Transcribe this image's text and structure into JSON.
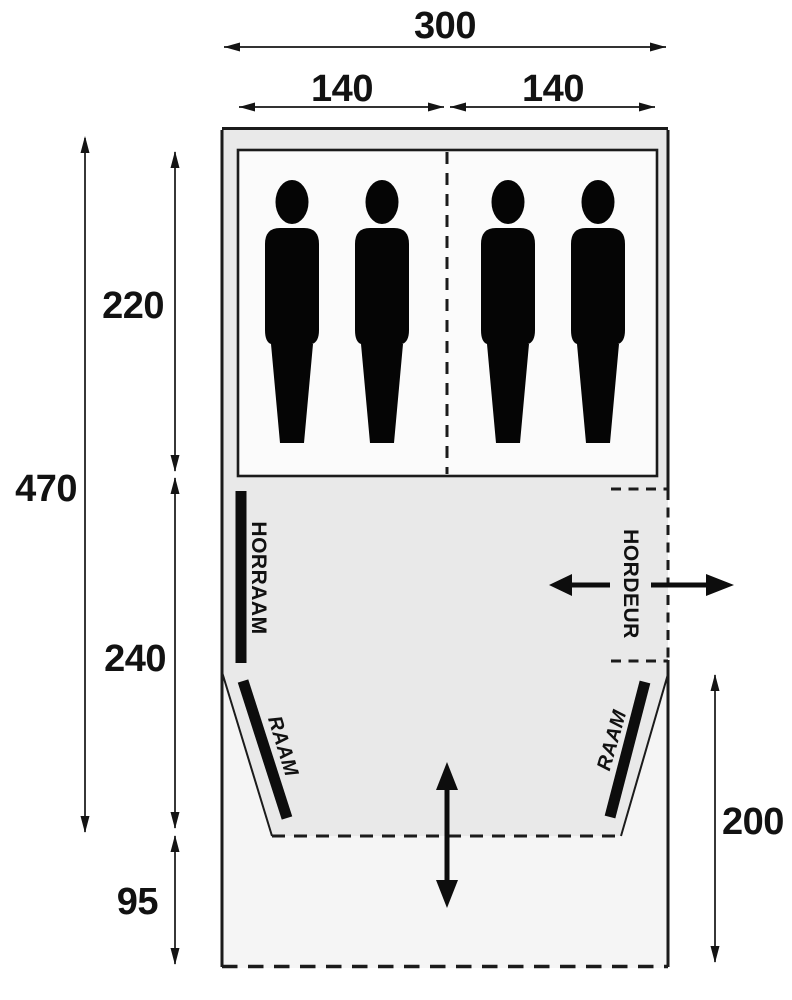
{
  "diagram": {
    "kind": "tent-floorplan",
    "dims": {
      "total_width": "300",
      "left_cabin_width": "140",
      "right_cabin_width": "140",
      "total_depth": "470",
      "sleeping_depth": "220",
      "living_depth": "240",
      "canopy_depth": "95",
      "side_section_depth": "200"
    },
    "labels": {
      "left_mesh_window": "HORRAAM",
      "side_mesh_door": "HORDEUR",
      "left_window": "RAAM",
      "right_window": "RAAM"
    },
    "figures": {
      "count": 4,
      "icon": "person-silhouette"
    },
    "colors": {
      "ink": "#141414",
      "living_area": "#e9e9e9",
      "sleeping_area": "#fbfbfb",
      "canopy_area": "#f5f5f5",
      "background": "#ffffff"
    }
  }
}
